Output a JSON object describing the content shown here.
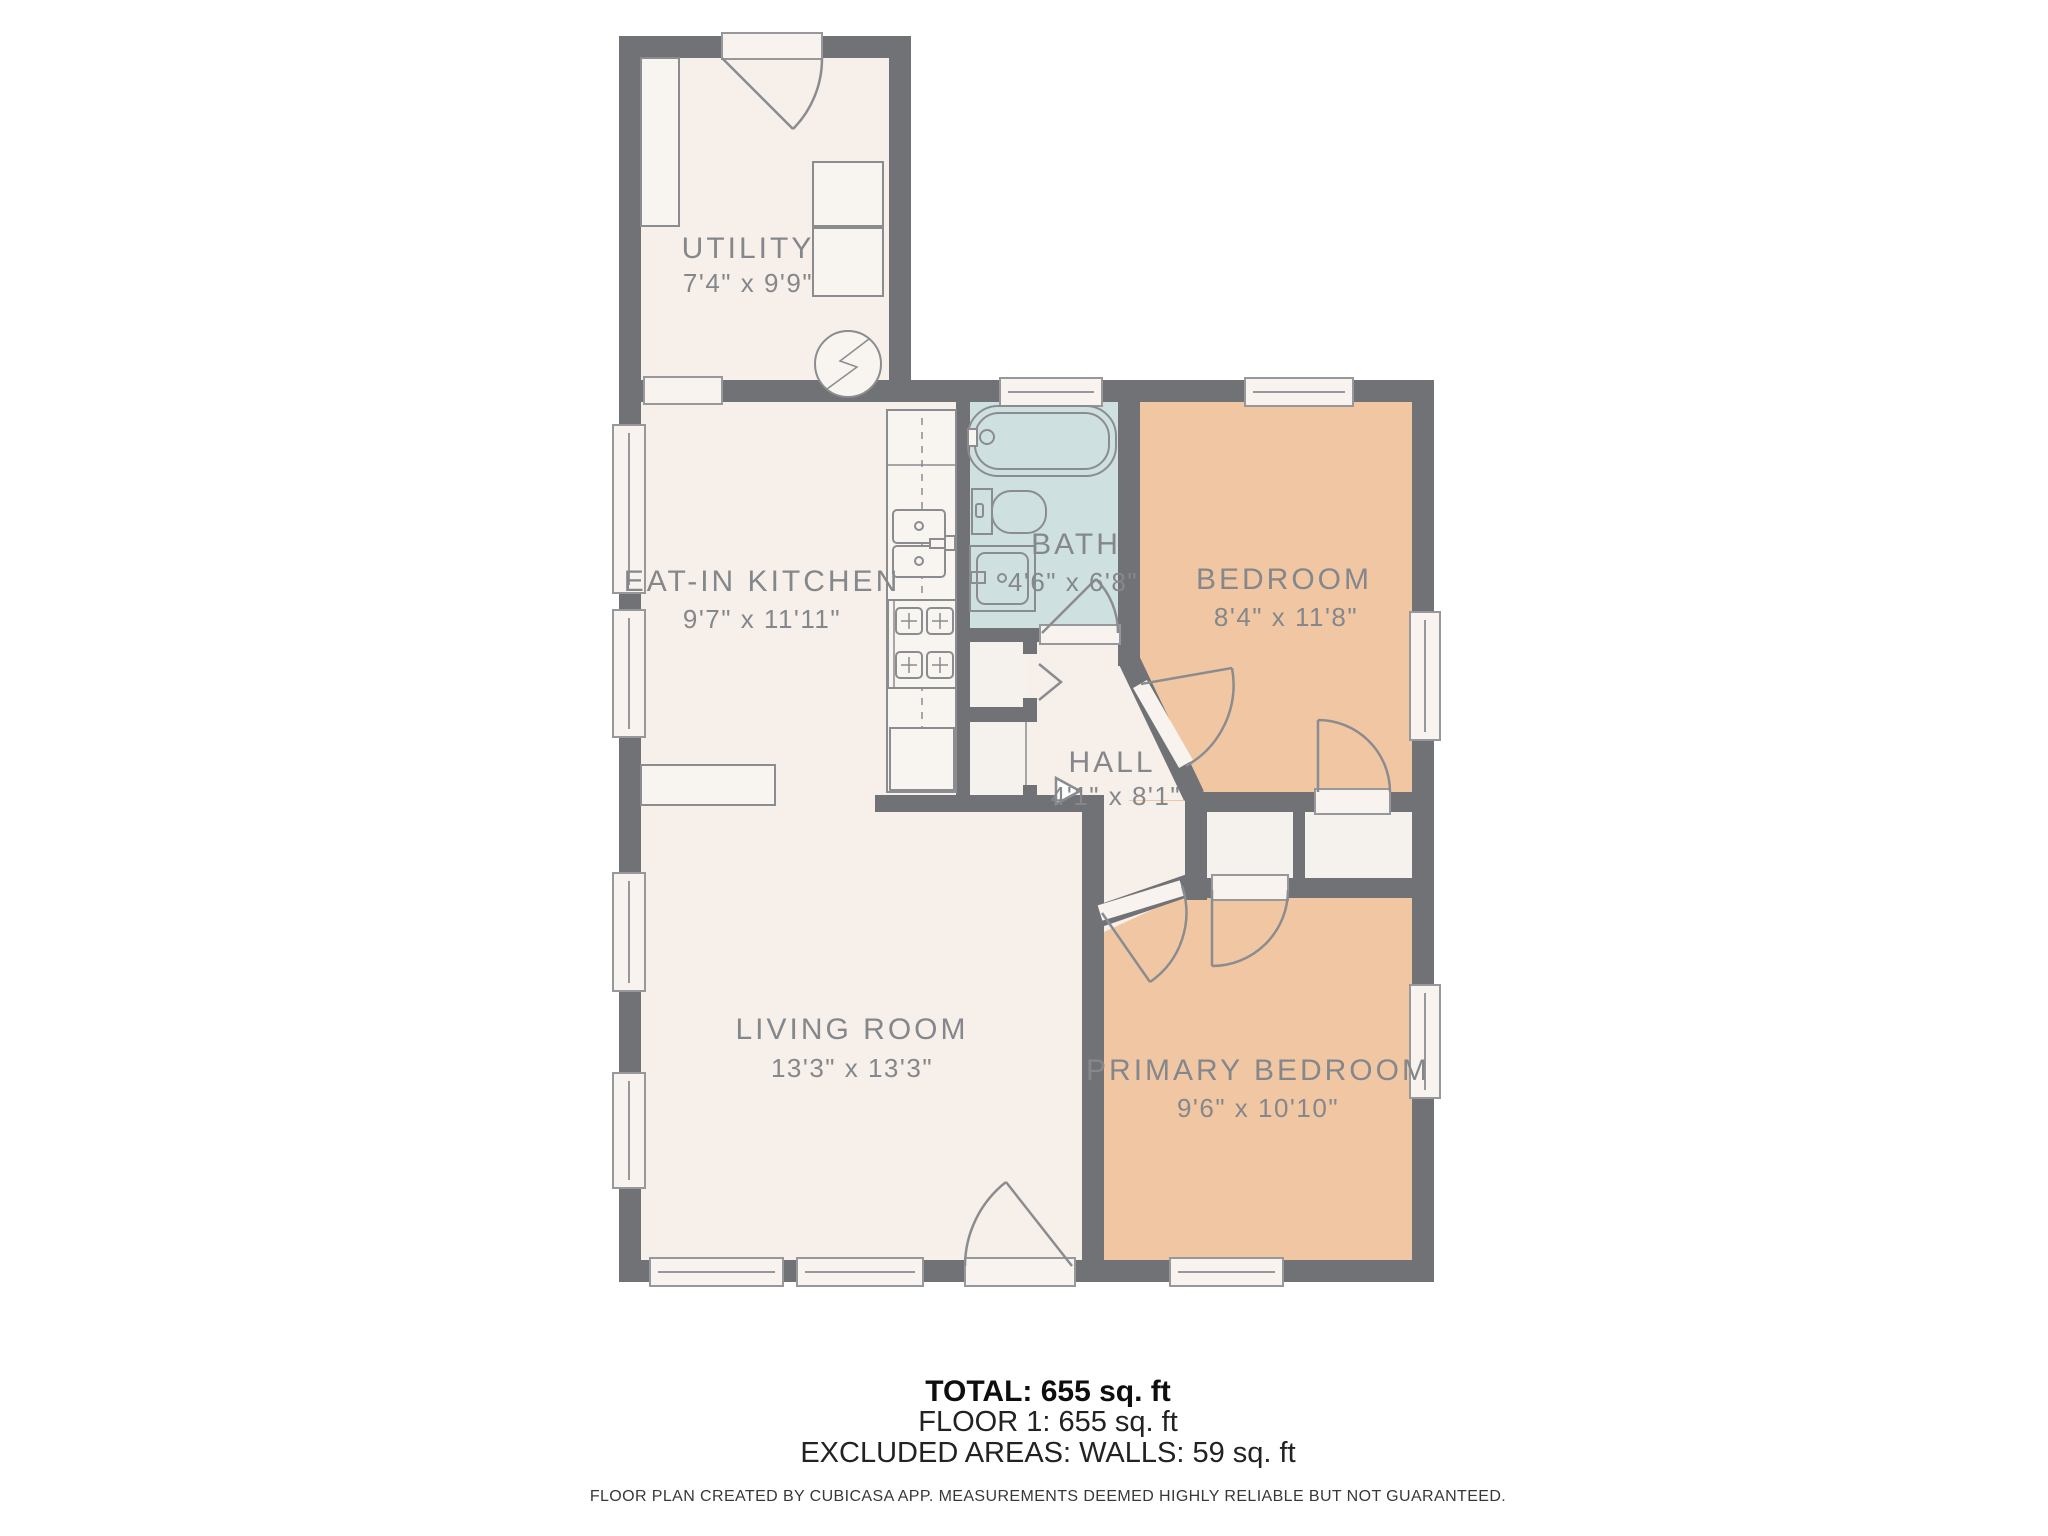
{
  "colors": {
    "wall": "#717275",
    "floor": "#f7efe9",
    "bedroom": "#f1c7a3",
    "bath": "#cfe0e0",
    "closet": "#f5f1ec",
    "threshold": "#f8f3ef"
  },
  "rooms": {
    "utility": {
      "name": "UTILITY",
      "dims": "7'4\" x 9'9\""
    },
    "kitchen": {
      "name": "EAT-IN KITCHEN",
      "dims": "9'7\" x 11'11\""
    },
    "bath": {
      "name": "BATH",
      "dims": "4'6\" x 6'8\""
    },
    "bedroom": {
      "name": "BEDROOM",
      "dims": "8'4\" x 11'8\""
    },
    "hall": {
      "name": "HALL",
      "dims": "4'1\" x 8'1\""
    },
    "living": {
      "name": "LIVING ROOM",
      "dims": "13'3\" x 13'3\""
    },
    "primary": {
      "name": "PRIMARY BEDROOM",
      "dims": "9'6\" x 10'10\""
    }
  },
  "summary": {
    "total": "TOTAL: 655 sq. ft",
    "floor1": "FLOOR 1: 655 sq. ft",
    "excluded": "EXCLUDED AREAS: WALLS: 59 sq. ft"
  },
  "footer": {
    "disclaimer": "FLOOR PLAN CREATED BY CUBICASA APP. MEASUREMENTS DEEMED HIGHLY RELIABLE BUT NOT GUARANTEED."
  }
}
